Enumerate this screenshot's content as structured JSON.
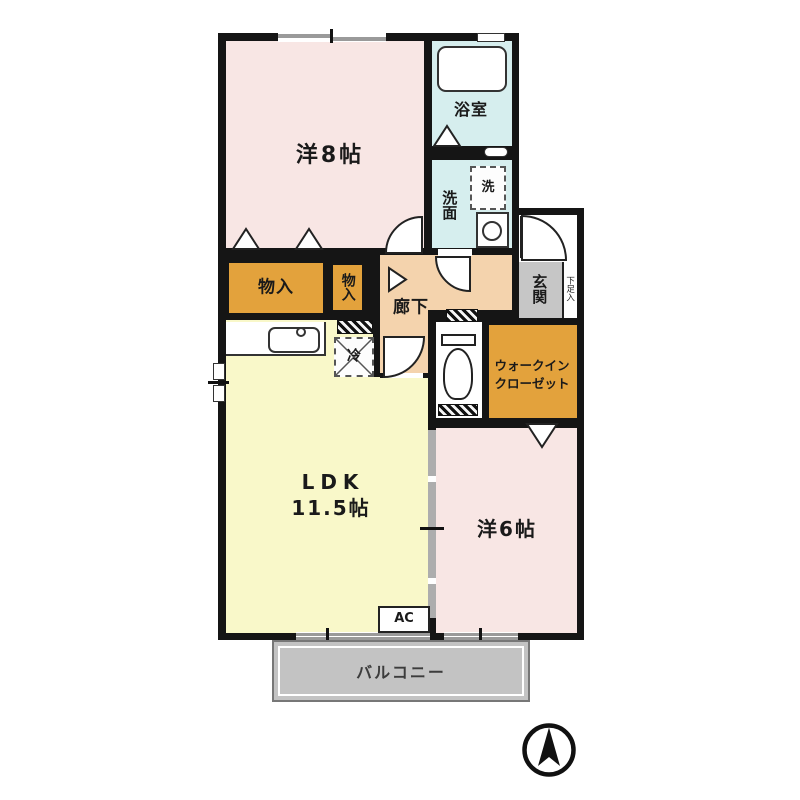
{
  "rooms": {
    "western8": {
      "label": "洋8帖",
      "color": "#f8e6e4"
    },
    "bath": {
      "label": "浴室",
      "color": "#d6eeee"
    },
    "washroom": {
      "label": "洗面",
      "color": "#d6eeee"
    },
    "washer": {
      "label": "洗"
    },
    "hallway": {
      "label": "廊下",
      "color": "#f4d3ad"
    },
    "entrance": {
      "label": "玄関",
      "color": "#c6c6c6"
    },
    "shoe_storage": {
      "label": "下足入"
    },
    "storage_left": {
      "label": "物入",
      "color": "#e3a23c"
    },
    "storage_right": {
      "label": "物入",
      "color": "#e3a23c"
    },
    "walk_in_closet": {
      "label_line1": "ウォークイン",
      "label_line2": "クローゼット",
      "color": "#e3a23c"
    },
    "ldk": {
      "label": "LDK",
      "size": "11.5帖",
      "color": "#f9f8c9"
    },
    "western6": {
      "label": "洋6帖",
      "color": "#f8e6e4"
    },
    "refrigerator": {
      "label": "冷"
    },
    "air_conditioner": {
      "label": "AC"
    },
    "balcony": {
      "label": "バルコニー",
      "color": "#c3c3c3"
    }
  },
  "compass": {
    "direction": "north"
  },
  "wall_color": "#151515"
}
